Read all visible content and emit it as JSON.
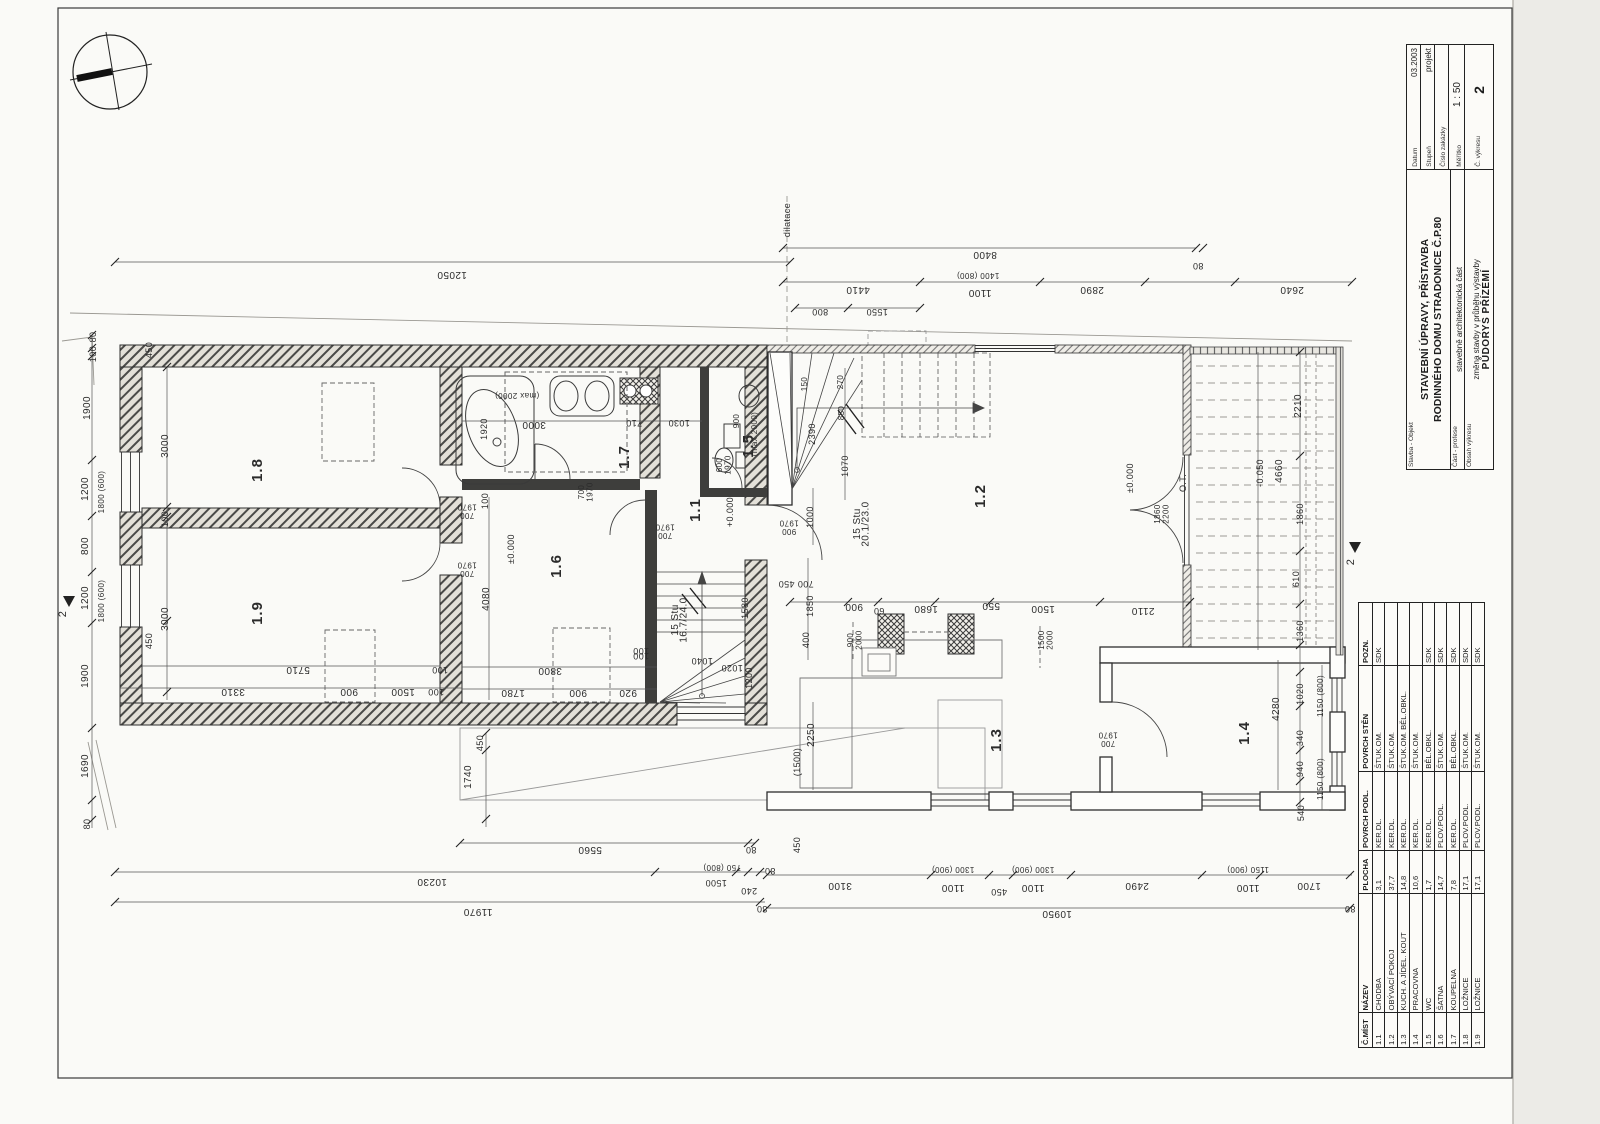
{
  "titleblock": {
    "stavba_label": "Stavba - Objekt",
    "title_line1": "STAVEBNÍ ÚPRAVY, PŘÍSTAVBA",
    "title_line2": "RODINNÉHO DOMU STRADONICE Č.P.80",
    "cast_label": "Část - profese",
    "cast_value": "stavebně architektonická část",
    "obsah_label": "Obsah výkresu",
    "obsah_value": "změna stavby v průběhu výstavby",
    "obsah_value2": "PŮDORYS PŘÍZEMÍ",
    "datum_label": "Datum",
    "datum_value": "03.2003",
    "stupen_label": "Stupeň",
    "stupen_value": "projekt",
    "cislo_label": "Číslo zakázky",
    "cislo_value": "",
    "meritko_label": "Měřítko",
    "meritko_value": "1 : 50",
    "cvykresu_label": "Č. výkresu",
    "cvykresu_value": "2"
  },
  "legend": {
    "headers": [
      "Č.MÍST",
      "NÁZEV",
      "PLOCHA",
      "POVRCH PODL.",
      "POVRCH STĚN",
      "POZN."
    ],
    "rows": [
      [
        "1.1",
        "CHODBA",
        "3,1",
        "KER.DL.",
        "ŠTUK.OM.",
        "SDK"
      ],
      [
        "1.2",
        "OBÝVACÍ POKOJ",
        "37,7",
        "KER.DL.",
        "ŠTUK.OM.",
        ""
      ],
      [
        "1.3",
        "KUCH. A JÍDEL. KOUT",
        "14,8",
        "KER.DL.",
        "ŠTUK.OM. BĚL.OBKL.",
        ""
      ],
      [
        "1.4",
        "PRACOVNA",
        "10,6",
        "KER.DL.",
        "ŠTUK.OM.",
        ""
      ],
      [
        "1.5",
        "WC",
        "1,7",
        "KER.DL.",
        "BĚL.OBKL.",
        "SDK"
      ],
      [
        "1.6",
        "ŠATNA",
        "14,7",
        "PLOV.PODL.",
        "ŠTUK.OM.",
        "SDK"
      ],
      [
        "1.7",
        "KOUPELNA",
        "7,8",
        "KER.DL.",
        "BĚL.OBKL.",
        "SDK"
      ],
      [
        "1.8",
        "LOŽNICE",
        "17,1",
        "PLOV.PODL.",
        "ŠTUK.OM.",
        "SDK"
      ],
      [
        "1.9",
        "LOŽNICE",
        "17,1",
        "PLOV.PODL.",
        "ŠTUK.OM.",
        "SDK"
      ]
    ]
  },
  "plan": {
    "annotations": [
      {
        "t": "12050",
        "x": 452,
        "y": 272,
        "r": 180
      },
      {
        "t": "dilatace",
        "x": 790,
        "y": 220,
        "r": -90,
        "s": 9
      },
      {
        "t": "8400",
        "x": 985,
        "y": 252,
        "r": 180
      },
      {
        "t": "80",
        "x": 1198,
        "y": 263,
        "r": 180,
        "s": 9
      },
      {
        "t": "4410",
        "x": 858,
        "y": 287,
        "r": 180
      },
      {
        "t": "1400 (800)",
        "x": 978,
        "y": 273,
        "r": 180,
        "s": 8
      },
      {
        "t": "1100",
        "x": 980,
        "y": 290,
        "r": 180
      },
      {
        "t": "2890",
        "x": 1092,
        "y": 287,
        "r": 180
      },
      {
        "t": "2640",
        "x": 1292,
        "y": 287,
        "r": 180
      },
      {
        "t": "800",
        "x": 820,
        "y": 309,
        "r": 180,
        "s": 9
      },
      {
        "t": "1550",
        "x": 877,
        "y": 309,
        "r": 180,
        "s": 9
      },
      {
        "t": "80",
        "x": 96,
        "y": 337,
        "r": -90,
        "s": 9
      },
      {
        "t": "100",
        "x": 96,
        "y": 354,
        "r": -90,
        "s": 9
      },
      {
        "t": "1900",
        "x": 90,
        "y": 408,
        "r": -90
      },
      {
        "t": "1200",
        "x": 88,
        "y": 489,
        "r": -90
      },
      {
        "t": "1800 (600)",
        "x": 104,
        "y": 492,
        "r": -90,
        "s": 8
      },
      {
        "t": "800",
        "x": 88,
        "y": 546,
        "r": -90
      },
      {
        "t": "1200",
        "x": 88,
        "y": 598,
        "r": -90
      },
      {
        "t": "1800 (600)",
        "x": 104,
        "y": 601,
        "r": -90,
        "s": 8
      },
      {
        "t": "1900",
        "x": 88,
        "y": 676,
        "r": -90
      },
      {
        "t": "1690",
        "x": 88,
        "y": 766,
        "r": -90
      },
      {
        "t": "80",
        "x": 90,
        "y": 824,
        "r": -90,
        "s": 9
      },
      {
        "t": "2",
        "x": 66,
        "y": 614,
        "r": -90,
        "s": 11
      },
      {
        "t": "2",
        "x": 1354,
        "y": 562,
        "r": -90,
        "s": 11
      },
      {
        "t": "450",
        "x": 152,
        "y": 350,
        "r": -90,
        "s": 9
      },
      {
        "t": "3000",
        "x": 168,
        "y": 446,
        "r": -90
      },
      {
        "t": "100",
        "x": 168,
        "y": 519,
        "r": -90,
        "s": 9
      },
      {
        "t": "3000",
        "x": 168,
        "y": 619,
        "r": -90
      },
      {
        "t": "450",
        "x": 152,
        "y": 641,
        "r": -90,
        "s": 9
      },
      {
        "t": "1.8",
        "x": 262,
        "y": 470,
        "r": -90,
        "s": 15
      },
      {
        "t": "1.9",
        "x": 262,
        "y": 613,
        "r": -90,
        "s": 15
      },
      {
        "t": "5710",
        "x": 298,
        "y": 667,
        "r": 180
      },
      {
        "t": "100",
        "x": 440,
        "y": 667,
        "r": 180,
        "s": 9
      },
      {
        "t": "3310",
        "x": 233,
        "y": 689,
        "r": 180
      },
      {
        "t": "900",
        "x": 349,
        "y": 689,
        "r": 180
      },
      {
        "t": "1500",
        "x": 403,
        "y": 689,
        "r": 180
      },
      {
        "t": "100",
        "x": 436,
        "y": 689,
        "r": 180,
        "s": 9
      },
      {
        "t": "1920",
        "x": 487,
        "y": 429,
        "r": -90,
        "s": 9
      },
      {
        "t": "3000",
        "x": 534,
        "y": 422,
        "r": 180
      },
      {
        "t": "(max 2000)",
        "x": 517,
        "y": 393,
        "r": 180,
        "s": 8
      },
      {
        "t": "710",
        "x": 634,
        "y": 420,
        "r": 180,
        "s": 9
      },
      {
        "t": "1030",
        "x": 679,
        "y": 420,
        "r": 180,
        "s": 9
      },
      {
        "t": "1.7",
        "x": 629,
        "y": 457,
        "r": -90,
        "s": 15
      },
      {
        "t": "700",
        "t2": "1970",
        "x": 584,
        "y": 492,
        "r": -90,
        "s": 8
      },
      {
        "t": "1.5",
        "x": 753,
        "y": 446,
        "r": -90,
        "s": 15
      },
      {
        "t": "900",
        "x": 739,
        "y": 421,
        "r": -90,
        "s": 8
      },
      {
        "t": "(max 2000)",
        "x": 757,
        "y": 434,
        "r": -90,
        "s": 8
      },
      {
        "t": "600",
        "t2": "1970",
        "x": 722,
        "y": 465,
        "r": -90,
        "s": 8
      },
      {
        "t": "1.1",
        "x": 700,
        "y": 510,
        "r": -90,
        "s": 15
      },
      {
        "t": "+0.000",
        "x": 733,
        "y": 512,
        "r": -90,
        "s": 9
      },
      {
        "t": "700",
        "t2": "1970",
        "x": 467,
        "y": 513,
        "r": 180,
        "s": 8
      },
      {
        "t": "700",
        "t2": "1970",
        "x": 467,
        "y": 571,
        "r": 180,
        "s": 8
      },
      {
        "t": "700",
        "t2": "1970",
        "x": 665,
        "y": 533,
        "r": 180,
        "s": 8
      },
      {
        "t": "15 Stu",
        "t2": "16.7/24.0",
        "x": 678,
        "y": 620,
        "r": -90,
        "s": 10
      },
      {
        "t": "1580",
        "x": 748,
        "y": 608,
        "r": -90,
        "s": 9
      },
      {
        "t": "100",
        "x": 641,
        "y": 648,
        "r": 180,
        "s": 9
      },
      {
        "t": "1040",
        "x": 702,
        "y": 658,
        "r": 180,
        "s": 9
      },
      {
        "t": "1020",
        "x": 732,
        "y": 665,
        "r": 180,
        "s": 9
      },
      {
        "t": "1200",
        "x": 752,
        "y": 678,
        "r": -90,
        "s": 9
      },
      {
        "t": "1.6",
        "x": 561,
        "y": 566,
        "r": -90,
        "s": 15
      },
      {
        "t": "±0.000",
        "x": 514,
        "y": 549,
        "r": -90,
        "s": 9
      },
      {
        "t": "100",
        "x": 488,
        "y": 501,
        "r": -90,
        "s": 9
      },
      {
        "t": "4080",
        "x": 489,
        "y": 599,
        "r": -90
      },
      {
        "t": "3800",
        "x": 550,
        "y": 668,
        "r": 180
      },
      {
        "t": "100",
        "x": 641,
        "y": 653,
        "r": 180,
        "s": 9
      },
      {
        "t": "1780",
        "x": 513,
        "y": 690,
        "r": 180
      },
      {
        "t": "900",
        "x": 578,
        "y": 690,
        "r": 180
      },
      {
        "t": "920",
        "x": 628,
        "y": 690,
        "r": 180
      },
      {
        "t": "1.2",
        "x": 985,
        "y": 496,
        "r": -90,
        "s": 15
      },
      {
        "t": "15 Stu",
        "t2": "20.1/23.0",
        "x": 860,
        "y": 524,
        "r": -90,
        "s": 10
      },
      {
        "t": "900",
        "t2": "1970",
        "x": 789,
        "y": 529,
        "r": 180,
        "s": 8
      },
      {
        "t": "1000",
        "x": 813,
        "y": 517,
        "r": -90,
        "s": 9
      },
      {
        "t": "150",
        "x": 807,
        "y": 384,
        "r": -90,
        "s": 8
      },
      {
        "t": "270",
        "x": 843,
        "y": 382,
        "r": -90,
        "s": 8
      },
      {
        "t": "850",
        "x": 844,
        "y": 413,
        "r": -90,
        "s": 8
      },
      {
        "t": "2390",
        "x": 815,
        "y": 434,
        "r": -90,
        "s": 9
      },
      {
        "t": "1070",
        "x": 848,
        "y": 466,
        "r": -90,
        "s": 9
      },
      {
        "t": "700 450",
        "x": 796,
        "y": 581,
        "r": 180,
        "s": 9
      },
      {
        "t": "1850",
        "x": 813,
        "y": 606,
        "r": -90,
        "s": 9
      },
      {
        "t": "400",
        "x": 809,
        "y": 640,
        "r": -90,
        "s": 9
      },
      {
        "t": "±0.000",
        "x": 1133,
        "y": 478,
        "r": -90,
        "s": 9
      },
      {
        "t": "O.T.",
        "x": 1186,
        "y": 483,
        "r": -90,
        "s": 9
      },
      {
        "t": "1860",
        "t2": "2200",
        "x": 1160,
        "y": 514,
        "r": -90,
        "s": 8
      },
      {
        "t": "2110",
        "x": 1143,
        "y": 608,
        "r": 180
      },
      {
        "t": "1500",
        "x": 1043,
        "y": 606,
        "r": 180
      },
      {
        "t": "550",
        "x": 991,
        "y": 603,
        "r": 180
      },
      {
        "t": "1680",
        "x": 926,
        "y": 606,
        "r": 180
      },
      {
        "t": "60",
        "x": 879,
        "y": 608,
        "r": 180,
        "s": 9
      },
      {
        "t": "900",
        "x": 854,
        "y": 604,
        "r": 180
      },
      {
        "t": "1500",
        "t2": "2000",
        "x": 1044,
        "y": 640,
        "r": -90,
        "s": 8
      },
      {
        "t": "900",
        "t2": "2000",
        "x": 853,
        "y": 640,
        "r": -90,
        "s": 8
      },
      {
        "t": "1.3",
        "x": 1001,
        "y": 740,
        "r": -90,
        "s": 15
      },
      {
        "t": "2250",
        "x": 814,
        "y": 735,
        "r": -90
      },
      {
        "t": "(1500)",
        "x": 800,
        "y": 762,
        "r": -90,
        "s": 9
      },
      {
        "t": "1.4",
        "x": 1249,
        "y": 733,
        "r": -90,
        "s": 15
      },
      {
        "t": "4280",
        "x": 1279,
        "y": 709,
        "r": -90
      },
      {
        "t": "700",
        "t2": "1970",
        "x": 1108,
        "y": 741,
        "r": 180,
        "s": 8
      },
      {
        "t": "1360",
        "x": 1303,
        "y": 631,
        "r": -90,
        "s": 9
      },
      {
        "t": "1020",
        "x": 1303,
        "y": 694,
        "r": -90,
        "s": 9
      },
      {
        "t": "1150 (800)",
        "x": 1323,
        "y": 696,
        "r": -90,
        "s": 8
      },
      {
        "t": "340",
        "x": 1303,
        "y": 738,
        "r": -90,
        "s": 9
      },
      {
        "t": "940",
        "x": 1303,
        "y": 769,
        "r": -90,
        "s": 9
      },
      {
        "t": "1150 (800)",
        "x": 1323,
        "y": 779,
        "r": -90,
        "s": 8
      },
      {
        "t": "540",
        "x": 1304,
        "y": 813,
        "r": -90,
        "s": 9
      },
      {
        "t": "2210",
        "x": 1301,
        "y": 406,
        "r": -90
      },
      {
        "t": "4660",
        "x": 1282,
        "y": 471,
        "r": -90
      },
      {
        "t": "-0.050",
        "x": 1263,
        "y": 473,
        "r": -90,
        "s": 9
      },
      {
        "t": "1860",
        "x": 1303,
        "y": 514,
        "r": -90,
        "s": 9
      },
      {
        "t": "610",
        "x": 1299,
        "y": 579,
        "r": -90,
        "s": 9
      },
      {
        "t": "450",
        "x": 483,
        "y": 743,
        "r": -90,
        "s": 9
      },
      {
        "t": "1740",
        "x": 471,
        "y": 777,
        "r": -90
      },
      {
        "t": "5560",
        "x": 590,
        "y": 847,
        "r": 180
      },
      {
        "t": "80",
        "x": 751,
        "y": 847,
        "r": 180,
        "s": 9
      },
      {
        "t": "10230",
        "x": 432,
        "y": 879,
        "r": 180
      },
      {
        "t": "750 (800)",
        "x": 722,
        "y": 865,
        "r": 180,
        "s": 8
      },
      {
        "t": "1500",
        "x": 716,
        "y": 880,
        "r": 180,
        "s": 9
      },
      {
        "t": "240",
        "x": 749,
        "y": 888,
        "r": 180,
        "s": 9
      },
      {
        "t": "11970",
        "x": 478,
        "y": 909,
        "r": 180
      },
      {
        "t": "80",
        "x": 762,
        "y": 906,
        "r": 180,
        "s": 9
      },
      {
        "t": "450",
        "x": 800,
        "y": 845,
        "r": -90,
        "s": 9
      },
      {
        "t": "80",
        "x": 770,
        "y": 868,
        "r": 180,
        "s": 9
      },
      {
        "t": "3100",
        "x": 840,
        "y": 883,
        "r": 180
      },
      {
        "t": "1300 (900)",
        "x": 953,
        "y": 867,
        "r": 180,
        "s": 8
      },
      {
        "t": "1100",
        "x": 953,
        "y": 885,
        "r": 180
      },
      {
        "t": "450",
        "x": 999,
        "y": 889,
        "r": 180,
        "s": 9
      },
      {
        "t": "1300 (900)",
        "x": 1033,
        "y": 867,
        "r": 180,
        "s": 8
      },
      {
        "t": "1100",
        "x": 1033,
        "y": 885,
        "r": 180
      },
      {
        "t": "2490",
        "x": 1137,
        "y": 883,
        "r": 180
      },
      {
        "t": "1150 (900)",
        "x": 1248,
        "y": 867,
        "r": 180,
        "s": 8
      },
      {
        "t": "1100",
        "x": 1248,
        "y": 885,
        "r": 180
      },
      {
        "t": "1700",
        "x": 1309,
        "y": 883,
        "r": 180
      },
      {
        "t": "10950",
        "x": 1057,
        "y": 911,
        "r": 180
      },
      {
        "t": "80",
        "x": 1350,
        "y": 906,
        "r": 180,
        "s": 9
      }
    ]
  }
}
